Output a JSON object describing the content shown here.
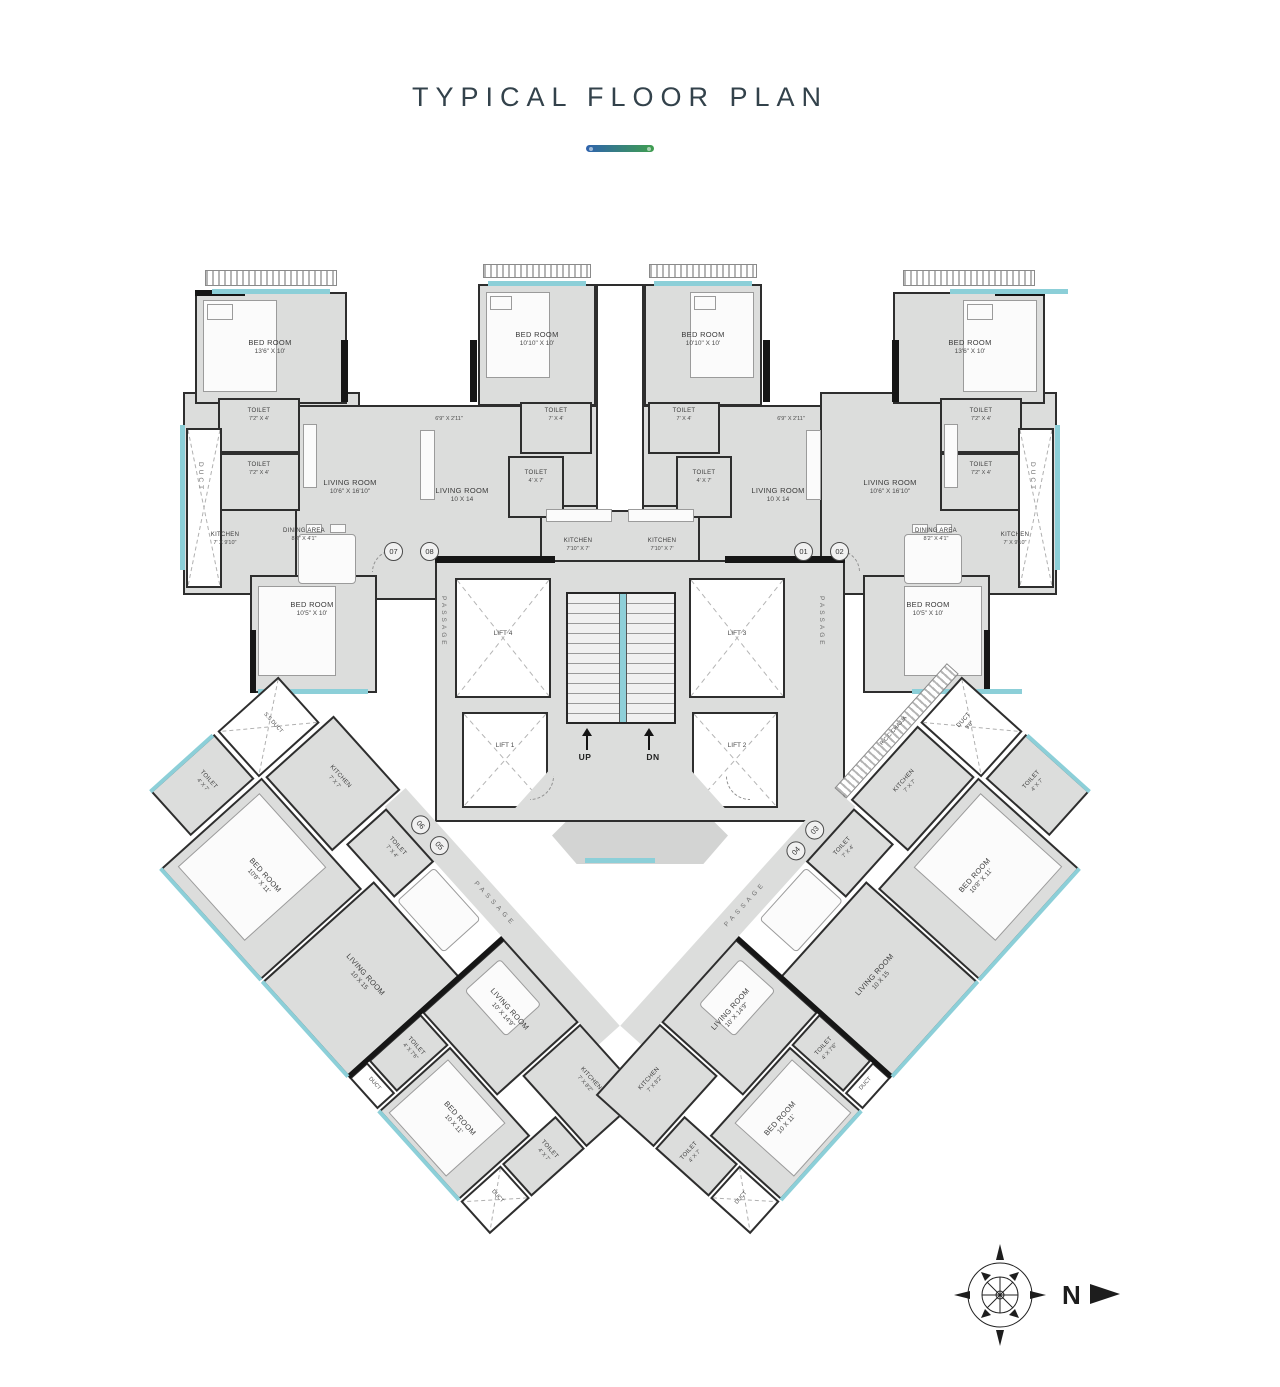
{
  "title": "TYPICAL FLOOR PLAN",
  "compass": {
    "north": "N"
  },
  "core": {
    "lift1": "LIFT 1",
    "lift2": "LIFT 2",
    "lift3": "LIFT 3",
    "lift4": "LIFT 4",
    "up": "UP",
    "dn": "DN",
    "passage": "PASSAGE"
  },
  "units": {
    "u07": {
      "number": "07",
      "bedroom": {
        "name": "BED ROOM",
        "dim": "13'6\" X 10'"
      },
      "toilet_a": {
        "name": "TOILET",
        "dim": "7'2\" X 4'"
      },
      "toilet_b": {
        "name": "TOILET",
        "dim": "7'2\" X 4'"
      },
      "duct": "DUCT",
      "kitchen": {
        "name": "KITCHEN",
        "dim": "7' X 9'10\""
      },
      "dining": {
        "name": "DINING AREA",
        "dim": "8'2\" X 4'1\""
      },
      "living": {
        "name": "LIVING ROOM",
        "dim": "10'6\" X 16'10\""
      },
      "bedroom_b": {
        "name": "BED ROOM",
        "dim": "10'5\" X 10'"
      }
    },
    "u08": {
      "number": "08",
      "bedroom": {
        "name": "BED ROOM",
        "dim": "10'10\" X 10'"
      },
      "foyer": "6'9\" X 2'11\"",
      "toilet_a": {
        "name": "TOILET",
        "dim": "7' X 4'"
      },
      "toilet_b": {
        "name": "TOILET",
        "dim": "4' X 7'"
      },
      "living": {
        "name": "LIVING ROOM",
        "dim": "10 X 14"
      },
      "kitchen": {
        "name": "KITCHEN",
        "dim": "7'10\" X 7'"
      }
    },
    "u01": {
      "number": "01",
      "bedroom": {
        "name": "BED ROOM",
        "dim": "10'10\" X 10'"
      },
      "foyer": "6'9\" X 2'11\"",
      "toilet_a": {
        "name": "TOILET",
        "dim": "7' X 4'"
      },
      "toilet_b": {
        "name": "TOILET",
        "dim": "4' X 7'"
      },
      "living": {
        "name": "LIVING ROOM",
        "dim": "10 X 14"
      },
      "kitchen": {
        "name": "KITCHEN",
        "dim": "7'10\" X 7'"
      }
    },
    "u02": {
      "number": "02",
      "bedroom": {
        "name": "BED ROOM",
        "dim": "13'6\" X 10'"
      },
      "toilet_a": {
        "name": "TOILET",
        "dim": "7'2\" X 4'"
      },
      "toilet_b": {
        "name": "TOILET",
        "dim": "7'2\" X 4'"
      },
      "duct": "DUCT",
      "kitchen": {
        "name": "KITCHEN",
        "dim": "7' X 9'10\""
      },
      "dining": {
        "name": "DINING AREA",
        "dim": "8'2\" X 4'1\""
      },
      "living": {
        "name": "LIVING ROOM",
        "dim": "10'6\" X 16'10\""
      },
      "bedroom_b": {
        "name": "BED ROOM",
        "dim": "10'5\" X 10'"
      }
    },
    "u06": {
      "number": "06",
      "ss_duct": "S.S DUCT",
      "kitchen": {
        "name": "KITCHEN",
        "dim": "7' X 7'"
      },
      "toilet_a": {
        "name": "TOILET",
        "dim": "7' X 4'"
      },
      "toilet_b": {
        "name": "TOILET",
        "dim": "4' X 7'"
      },
      "bedroom": {
        "name": "BED ROOM",
        "dim": "10'8\" X 11'"
      },
      "living": {
        "name": "LIVING ROOM",
        "dim": "10 X 15"
      }
    },
    "u05": {
      "number": "05",
      "living": {
        "name": "LIVING ROOM",
        "dim": "10' X 14'9\""
      },
      "kitchen": {
        "name": "KITCHEN",
        "dim": "7' X 8'2\""
      },
      "bedroom": {
        "name": "BED ROOM",
        "dim": "10 X 11'"
      },
      "toilet_a": {
        "name": "TOILET",
        "dim": "4' X 7'6\""
      },
      "toilet_b": {
        "name": "TOILET",
        "dim": "4' X 7'"
      },
      "duct": "DUCT",
      "tip_duct": "DUCT"
    },
    "u03": {
      "number": "03",
      "rcc_chajja": "R.C.C CHAJJA",
      "duct": {
        "name": "DUCT",
        "dim": "9'6\""
      },
      "kitchen": {
        "name": "KITCHEN",
        "dim": "7' X 7'"
      },
      "toilet_a": {
        "name": "TOILET",
        "dim": "7' X 4'"
      },
      "toilet_b": {
        "name": "TOILET",
        "dim": "4' X 7'"
      },
      "bedroom": {
        "name": "BED ROOM",
        "dim": "10'8\" X 11'"
      },
      "living": {
        "name": "LIVING ROOM",
        "dim": "10 X 15"
      }
    },
    "u04": {
      "number": "04",
      "living": {
        "name": "LIVING ROOM",
        "dim": "10' X 14'9\""
      },
      "kitchen": {
        "name": "KITCHEN",
        "dim": "7' X 8'2\""
      },
      "bedroom": {
        "name": "BED ROOM",
        "dim": "10 X 11'"
      },
      "toilet_a": {
        "name": "TOILET",
        "dim": "4' X 7'6\""
      },
      "toilet_b": {
        "name": "TOILET",
        "dim": "4' X 7'"
      },
      "duct": "DUCT",
      "tip_duct": "DUCT"
    }
  }
}
